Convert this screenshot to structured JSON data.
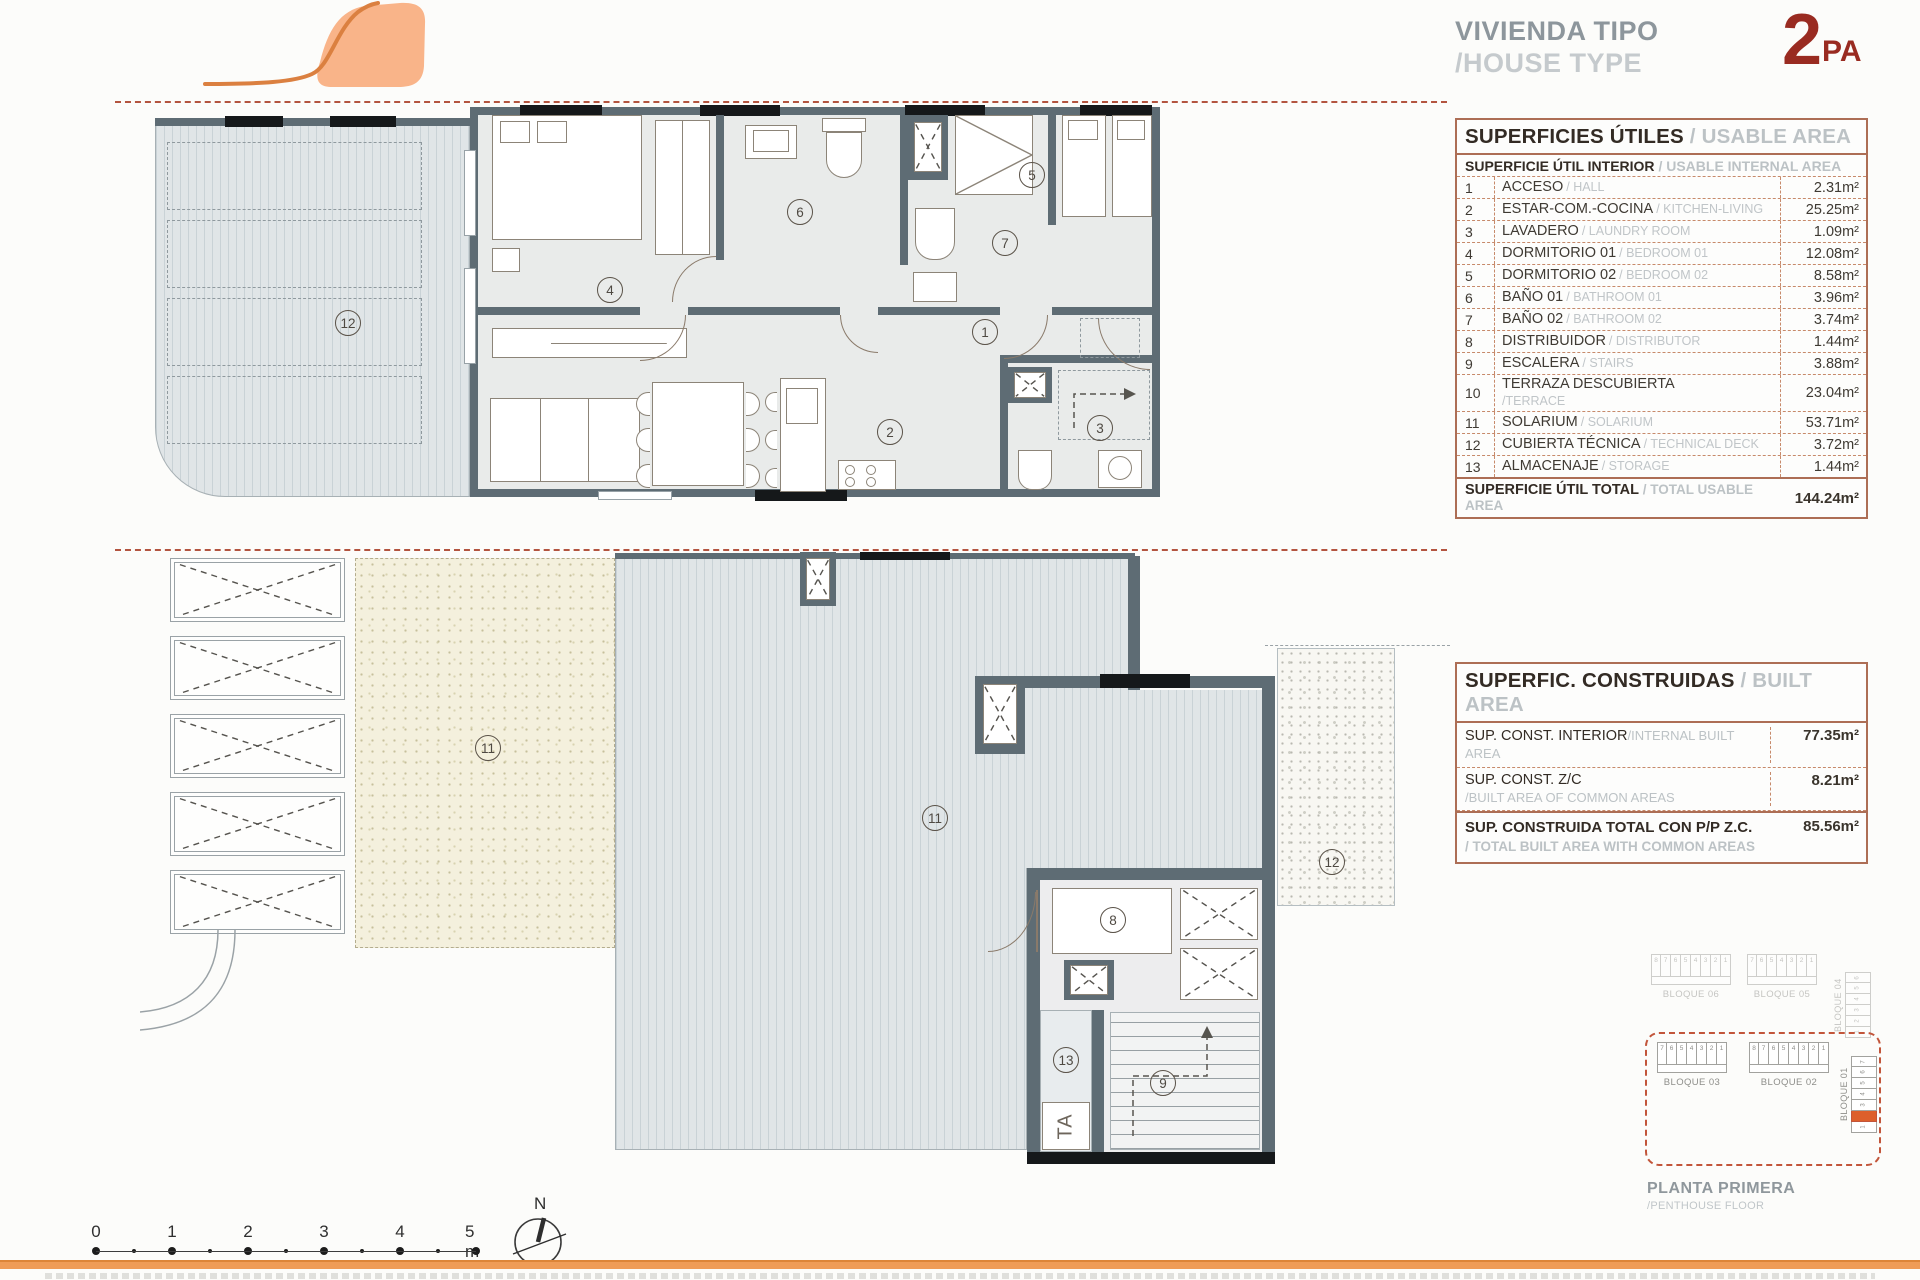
{
  "header": {
    "title_es": "VIVIENDA TIPO",
    "title_en": "/HOUSE TYPE",
    "type_number": "2",
    "type_suffix": "PA"
  },
  "usable_table": {
    "title_es": "SUPERFICIES ÚTILES",
    "title_en": "/ USABLE AREA",
    "subtitle_es": "SUPERFICIE ÚTIL INTERIOR",
    "subtitle_en": "/ USABLE INTERNAL AREA",
    "rows": [
      {
        "num": "1",
        "es": "ACCESO",
        "en": "/ HALL",
        "area": "2.31m²"
      },
      {
        "num": "2",
        "es": "ESTAR-COM.-COCINA",
        "en": "/ KITCHEN-LIVING",
        "area": "25.25m²"
      },
      {
        "num": "3",
        "es": "LAVADERO",
        "en": "/ LAUNDRY ROOM",
        "area": "1.09m²"
      },
      {
        "num": "4",
        "es": "DORMITORIO 01",
        "en": "/ BEDROOM 01",
        "area": "12.08m²"
      },
      {
        "num": "5",
        "es": "DORMITORIO 02",
        "en": "/ BEDROOM 02",
        "area": "8.58m²"
      },
      {
        "num": "6",
        "es": "BAÑO 01",
        "en": "/ BATHROOM 01",
        "area": "3.96m²"
      },
      {
        "num": "7",
        "es": "BAÑO 02",
        "en": "/ BATHROOM 02",
        "area": "3.74m²"
      },
      {
        "num": "8",
        "es": "DISTRIBUIDOR",
        "en": "/ DISTRIBUTOR",
        "area": "1.44m²"
      },
      {
        "num": "9",
        "es": "ESCALERA",
        "en": "/ STAIRS",
        "area": "3.88m²"
      },
      {
        "num": "10",
        "es": "TERRAZA DESCUBIERTA",
        "en": "/TERRACE",
        "area": "23.04m²",
        "two_line": true
      },
      {
        "num": "11",
        "es": "SOLARIUM",
        "en": "/ SOLARIUM",
        "area": "53.71m²"
      },
      {
        "num": "12",
        "es": "CUBIERTA TÉCNICA",
        "en": "/ TECHNICAL DECK",
        "area": "3.72m²"
      },
      {
        "num": "13",
        "es": "ALMACENAJE",
        "en": "/ STORAGE",
        "area": "1.44m²"
      }
    ],
    "total_es": "SUPERFICIE ÚTIL TOTAL",
    "total_en": "/ TOTAL USABLE AREA",
    "total_area": "144.24m²"
  },
  "built_table": {
    "title_es": "SUPERFIC. CONSTRUIDAS",
    "title_en": "/ BUILT AREA",
    "rows": [
      {
        "es": "SUP. CONST. INTERIOR",
        "en": "/INTERNAL BUILT AREA",
        "area": "77.35m²"
      },
      {
        "es": "SUP. CONST. Z/C",
        "en": "/BUILT AREA OF COMMON AREAS",
        "area": "8.21m²",
        "two_line": true
      }
    ],
    "total_es": "SUP. CONSTRUIDA TOTAL CON P/P Z.C.",
    "total_en": "/ TOTAL BUILT AREA WITH COMMON AREAS",
    "total_area": "85.56m²"
  },
  "key_plan": {
    "faded_blocks": [
      {
        "label": "BLOQUE 06",
        "units": [
          "8",
          "7",
          "6",
          "5",
          "4",
          "3",
          "2",
          "1"
        ]
      },
      {
        "label": "BLOQUE 05",
        "units": [
          "7",
          "6",
          "5",
          "4",
          "3",
          "2",
          "1"
        ]
      },
      {
        "label": "BLOQUE 04",
        "units": [
          "6",
          "5",
          "4",
          "3",
          "2",
          "1"
        ],
        "vertical": true
      }
    ],
    "active_blocks": [
      {
        "label": "BLOQUE 03",
        "units": [
          "7",
          "6",
          "5",
          "4",
          "3",
          "2",
          "1"
        ]
      },
      {
        "label": "BLOQUE 02",
        "units": [
          "8",
          "7",
          "6",
          "5",
          "4",
          "3",
          "2",
          "1"
        ]
      },
      {
        "label": "BLOQUE 01",
        "units": [
          "7",
          "6",
          "5",
          "4",
          "3",
          "2",
          "1"
        ],
        "vertical": true,
        "highlight": "2"
      }
    ],
    "caption_es": "PLANTA PRIMERA",
    "caption_en": "/PENTHOUSE FLOOR"
  },
  "scale_bar": {
    "ticks": [
      "0",
      "1",
      "2",
      "3",
      "4",
      "5 m"
    ]
  },
  "north": {
    "label": "N"
  },
  "plans": {
    "upper": {
      "rooms": [
        "12",
        "4",
        "6",
        "7",
        "5",
        "1",
        "2",
        "3"
      ]
    },
    "lower": {
      "rooms": [
        "11",
        "11",
        "8",
        "9",
        "13",
        "12"
      ],
      "storage_label": "TA"
    }
  }
}
